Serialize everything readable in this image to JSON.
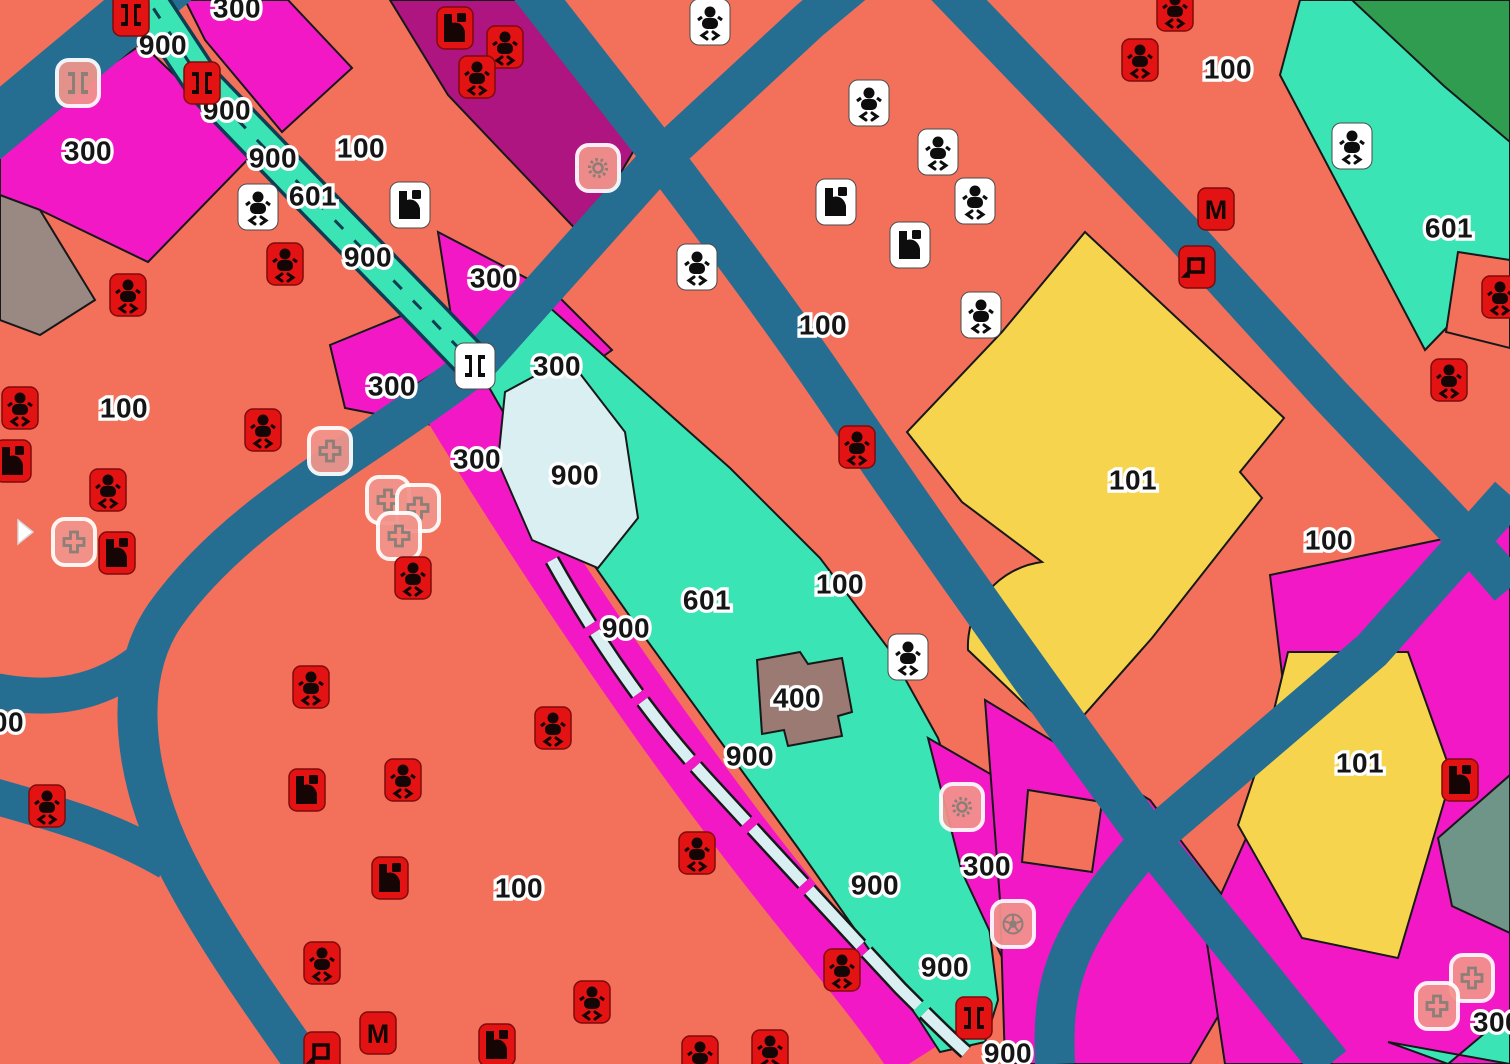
{
  "map": {
    "colors": {
      "salmon": "#F3715B",
      "magenta": "#F318C5",
      "purple": "#AE1581",
      "teal": "#3BE4B4",
      "cyan": "#DAEFF2",
      "yellow": "#F6D44D",
      "brown": "#9A7A72",
      "gray": "#9A8982",
      "sage": "#6F9589",
      "green": "#2F9C50",
      "road": "#266D92",
      "stream_casing": "#0D3D52",
      "icon_red": "#E31313"
    },
    "zone_labels": [
      {
        "text": "300",
        "x": 237,
        "y": 8
      },
      {
        "text": "900",
        "x": 163,
        "y": 45
      },
      {
        "text": "900",
        "x": 227,
        "y": 110
      },
      {
        "text": "300",
        "x": 88,
        "y": 151
      },
      {
        "text": "900",
        "x": 273,
        "y": 158
      },
      {
        "text": "100",
        "x": 361,
        "y": 148
      },
      {
        "text": "601",
        "x": 313,
        "y": 196
      },
      {
        "text": "900",
        "x": 368,
        "y": 257
      },
      {
        "text": "300",
        "x": 494,
        "y": 278
      },
      {
        "text": "100",
        "x": 823,
        "y": 325
      },
      {
        "text": "100",
        "x": 1228,
        "y": 69
      },
      {
        "text": "601",
        "x": 1449,
        "y": 228
      },
      {
        "text": "300",
        "x": 557,
        "y": 366
      },
      {
        "text": "300",
        "x": 392,
        "y": 386
      },
      {
        "text": "100",
        "x": 124,
        "y": 408
      },
      {
        "text": "300",
        "x": 477,
        "y": 459
      },
      {
        "text": "900",
        "x": 575,
        "y": 475
      },
      {
        "text": "101",
        "x": 1133,
        "y": 480
      },
      {
        "text": "100",
        "x": 1329,
        "y": 540
      },
      {
        "text": "100",
        "x": 840,
        "y": 584
      },
      {
        "text": "601",
        "x": 707,
        "y": 600
      },
      {
        "text": "900",
        "x": 626,
        "y": 628
      },
      {
        "text": "400",
        "x": 797,
        "y": 698
      },
      {
        "text": "00",
        "x": 8,
        "y": 722
      },
      {
        "text": "900",
        "x": 750,
        "y": 756
      },
      {
        "text": "101",
        "x": 1360,
        "y": 763
      },
      {
        "text": "100",
        "x": 519,
        "y": 888
      },
      {
        "text": "900",
        "x": 875,
        "y": 885
      },
      {
        "text": "300",
        "x": 987,
        "y": 866
      },
      {
        "text": "900",
        "x": 945,
        "y": 967
      },
      {
        "text": "900",
        "x": 1008,
        "y": 1053
      },
      {
        "text": "300",
        "x": 1497,
        "y": 1022
      }
    ],
    "icons": [
      {
        "type": "bridge",
        "style": "red",
        "x": 131,
        "y": 15
      },
      {
        "type": "bridge",
        "style": "faded",
        "x": 78,
        "y": 83
      },
      {
        "type": "bridge",
        "style": "red",
        "x": 202,
        "y": 83
      },
      {
        "type": "fitness",
        "style": "red",
        "x": 455,
        "y": 28
      },
      {
        "type": "baby",
        "style": "red",
        "x": 505,
        "y": 47
      },
      {
        "type": "baby",
        "style": "red",
        "x": 477,
        "y": 77
      },
      {
        "type": "baby",
        "style": "white",
        "x": 710,
        "y": 22
      },
      {
        "type": "baby",
        "style": "white",
        "x": 869,
        "y": 103
      },
      {
        "type": "baby",
        "style": "white",
        "x": 938,
        "y": 152
      },
      {
        "type": "baby",
        "style": "white",
        "x": 975,
        "y": 201
      },
      {
        "type": "fitness",
        "style": "white",
        "x": 836,
        "y": 202
      },
      {
        "type": "fitness",
        "style": "white",
        "x": 910,
        "y": 245
      },
      {
        "type": "baby",
        "style": "white",
        "x": 697,
        "y": 267
      },
      {
        "type": "baby",
        "style": "white",
        "x": 981,
        "y": 315
      },
      {
        "type": "baby",
        "style": "red",
        "x": 1175,
        "y": 10
      },
      {
        "type": "baby",
        "style": "red",
        "x": 1140,
        "y": 60
      },
      {
        "type": "baby",
        "style": "white",
        "x": 1352,
        "y": 146
      },
      {
        "type": "metro",
        "style": "red",
        "x": 1216,
        "y": 209,
        "label": "M"
      },
      {
        "type": "square",
        "style": "red",
        "x": 1197,
        "y": 267
      },
      {
        "type": "baby",
        "style": "red",
        "x": 1500,
        "y": 297
      },
      {
        "type": "baby",
        "style": "red",
        "x": 1449,
        "y": 380
      },
      {
        "type": "sun",
        "style": "faded",
        "x": 598,
        "y": 168
      },
      {
        "type": "fitness",
        "style": "white",
        "x": 410,
        "y": 205
      },
      {
        "type": "baby",
        "style": "white",
        "x": 258,
        "y": 207
      },
      {
        "type": "baby",
        "style": "red",
        "x": 285,
        "y": 264
      },
      {
        "type": "baby",
        "style": "red",
        "x": 128,
        "y": 295
      },
      {
        "type": "bridge",
        "style": "white",
        "x": 475,
        "y": 366
      },
      {
        "type": "baby",
        "style": "red",
        "x": 20,
        "y": 408
      },
      {
        "type": "baby",
        "style": "red",
        "x": 263,
        "y": 430
      },
      {
        "type": "fitness",
        "style": "red",
        "x": 13,
        "y": 461
      },
      {
        "type": "cross",
        "style": "faded",
        "x": 330,
        "y": 451
      },
      {
        "type": "baby",
        "style": "red",
        "x": 108,
        "y": 490
      },
      {
        "type": "cross",
        "style": "faded",
        "x": 388,
        "y": 500
      },
      {
        "type": "cross",
        "style": "faded",
        "x": 418,
        "y": 508
      },
      {
        "type": "arrow",
        "style": "white",
        "x": 20,
        "y": 532
      },
      {
        "type": "cross",
        "style": "faded",
        "x": 74,
        "y": 542
      },
      {
        "type": "fitness",
        "style": "red",
        "x": 117,
        "y": 553
      },
      {
        "type": "cross",
        "style": "faded",
        "x": 399,
        "y": 536
      },
      {
        "type": "baby",
        "style": "red",
        "x": 413,
        "y": 578
      },
      {
        "type": "baby",
        "style": "red",
        "x": 857,
        "y": 447
      },
      {
        "type": "baby",
        "style": "white",
        "x": 908,
        "y": 657
      },
      {
        "type": "baby",
        "style": "red",
        "x": 311,
        "y": 687
      },
      {
        "type": "baby",
        "style": "red",
        "x": 553,
        "y": 728
      },
      {
        "type": "baby",
        "style": "red",
        "x": 47,
        "y": 806
      },
      {
        "type": "fitness",
        "style": "red",
        "x": 307,
        "y": 790
      },
      {
        "type": "baby",
        "style": "red",
        "x": 403,
        "y": 780
      },
      {
        "type": "fitness",
        "style": "red",
        "x": 1460,
        "y": 780
      },
      {
        "type": "sun",
        "style": "faded",
        "x": 962,
        "y": 807
      },
      {
        "type": "baby",
        "style": "red",
        "x": 697,
        "y": 853
      },
      {
        "type": "fitness",
        "style": "red",
        "x": 390,
        "y": 878
      },
      {
        "type": "ball",
        "style": "faded",
        "x": 1013,
        "y": 924
      },
      {
        "type": "baby",
        "style": "red",
        "x": 322,
        "y": 963
      },
      {
        "type": "cross",
        "style": "faded",
        "x": 1472,
        "y": 978
      },
      {
        "type": "baby",
        "style": "red",
        "x": 842,
        "y": 970
      },
      {
        "type": "cross",
        "style": "faded",
        "x": 1437,
        "y": 1006
      },
      {
        "type": "baby",
        "style": "red",
        "x": 592,
        "y": 1002
      },
      {
        "type": "bridge",
        "style": "red",
        "x": 974,
        "y": 1018
      },
      {
        "type": "metro",
        "style": "red",
        "x": 378,
        "y": 1033,
        "label": "M"
      },
      {
        "type": "fitness",
        "style": "red",
        "x": 497,
        "y": 1045
      },
      {
        "type": "square",
        "style": "red",
        "x": 322,
        "y": 1053
      },
      {
        "type": "baby",
        "style": "red",
        "x": 700,
        "y": 1057
      },
      {
        "type": "baby",
        "style": "red",
        "x": 770,
        "y": 1051
      }
    ]
  }
}
